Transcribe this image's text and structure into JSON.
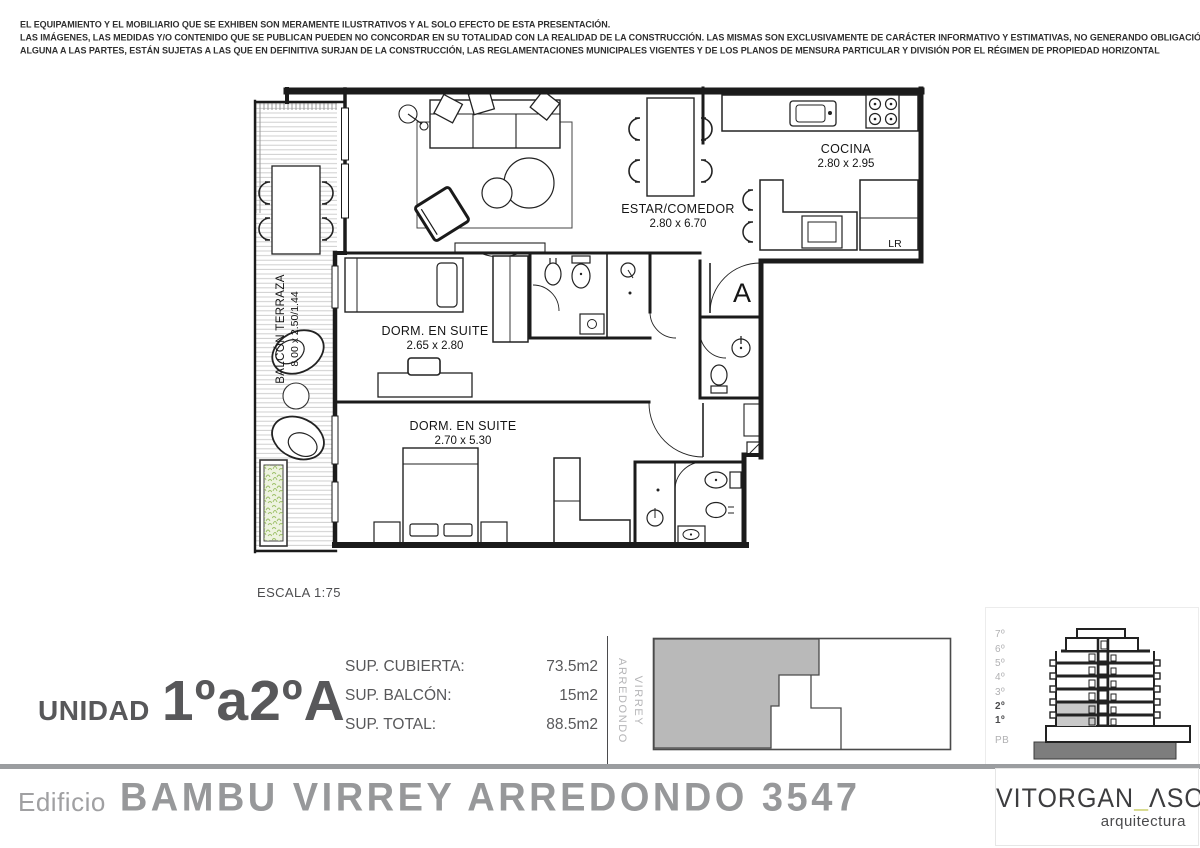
{
  "disclaimer": {
    "line1": "EL EQUIPAMIENTO Y EL MOBILIARIO QUE SE EXHIBEN SON MERAMENTE ILUSTRATIVOS Y AL SOLO EFECTO DE ESTA PRESENTACIÓN.",
    "line2": "LAS IMÁGENES, LAS MEDIDAS Y/O CONTENIDO QUE SE PUBLICAN PUEDEN NO CONCORDAR EN SU TOTALIDAD CON LA REALIDAD DE LA CONSTRUCCIÓN. LAS MISMAS SON EXCLUSIVAMENTE DE CARÁCTER INFORMATIVO Y ESTIMATIVAS, NO GENERANDO OBLIGACIÓN",
    "line3": "ALGUNA A LAS PARTES, ESTÁN SUJETAS A LAS QUE EN DEFINITIVA SURJAN DE LA CONSTRUCCIÓN, LAS REGLAMENTACIONES MUNICIPALES VIGENTES Y DE LOS PLANOS DE MENSURA PARTICULAR Y DIVISIÓN POR EL RÉGIMEN DE PROPIEDAD HORIZONTAL"
  },
  "plan": {
    "scale": "ESCALA 1:75",
    "entrance": "A",
    "laundry": "LR",
    "rooms": {
      "living": {
        "name": "ESTAR/COMEDOR",
        "dims": "2.80 x 6.70"
      },
      "kitchen": {
        "name": "COCINA",
        "dims": "2.80 x 2.95"
      },
      "bedroom1": {
        "name": "DORM. EN SUITE",
        "dims": "2.65 x 2.80"
      },
      "bedroom2": {
        "name": "DORM. EN SUITE",
        "dims": "2.70 x 5.30"
      },
      "balcony": {
        "name": "BALCÓN TERRAZA",
        "dims": "8.00 x 2.50/1.44"
      }
    }
  },
  "unit": {
    "label": "UNIDAD",
    "number": "1ºa2ºA"
  },
  "areas": {
    "covered": {
      "label": "SUP. CUBIERTA:",
      "value": "73.5m2"
    },
    "balcony": {
      "label": "SUP. BALCÓN:",
      "value": "15m2"
    },
    "total": {
      "label": "SUP. TOTAL:",
      "value": "88.5m2"
    }
  },
  "street": {
    "line1": "VIRREY",
    "line2": "ARREDONDO"
  },
  "elevation": {
    "floors": [
      "7º",
      "6º",
      "5º",
      "4º",
      "3º",
      "2º",
      "1º",
      "PB"
    ],
    "highlighted_floors": [
      "2º",
      "1º"
    ]
  },
  "footer": {
    "prefix": "Edificio",
    "building": "BAMBU VIRREY ARREDONDO 3547"
  },
  "logo": {
    "name1": "VITORGAN",
    "underscore": "_",
    "name2": "ΛSOC",
    "tagline": "arquitectura"
  },
  "colors": {
    "logo_accent_green": "#b6ba2a",
    "site_fill_gray": "#b9b9b9",
    "highlight_text_dark": "#4b4b4d",
    "muted_gray": "#b1b1b3",
    "title_gray": "#97989a",
    "planter_green": "#9dc068",
    "divider_gray": "#9b9da0"
  }
}
